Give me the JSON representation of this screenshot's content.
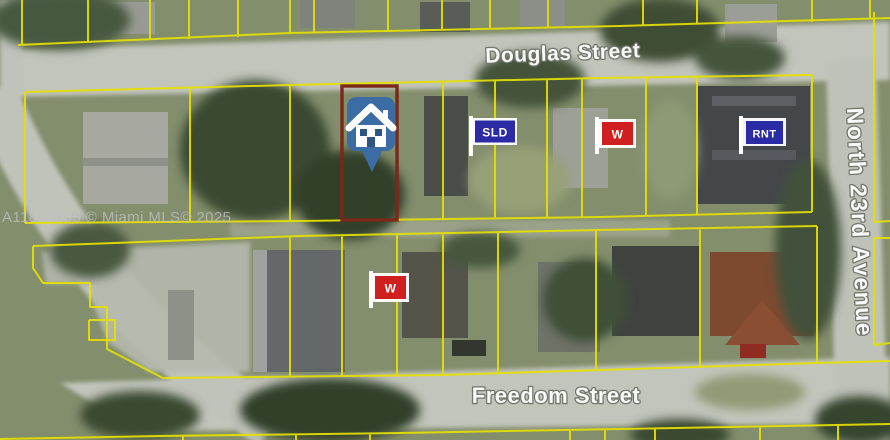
{
  "map": {
    "attribution": "A11875085 © Miami MLS© 2025",
    "streets": {
      "douglas": "Douglas Street",
      "freedom": "Freedom Street",
      "avenue": "North 23rd Avenue"
    },
    "markers": {
      "subject_pin": {
        "type": "house-pin"
      },
      "flag_sld": {
        "label": "SLD"
      },
      "flag_w_north": {
        "label": "W"
      },
      "flag_rnt": {
        "label": "RNT"
      },
      "flag_w_south": {
        "label": "W"
      }
    },
    "colors": {
      "parcel_line": "#e6e002",
      "selected_parcel_outline": "#7b2817",
      "pin_blue": "#3b6ca3",
      "flag_blue": "#2b2ba5",
      "flag_red": "#cf1f1f",
      "label_white": "#fdfdfd"
    }
  }
}
